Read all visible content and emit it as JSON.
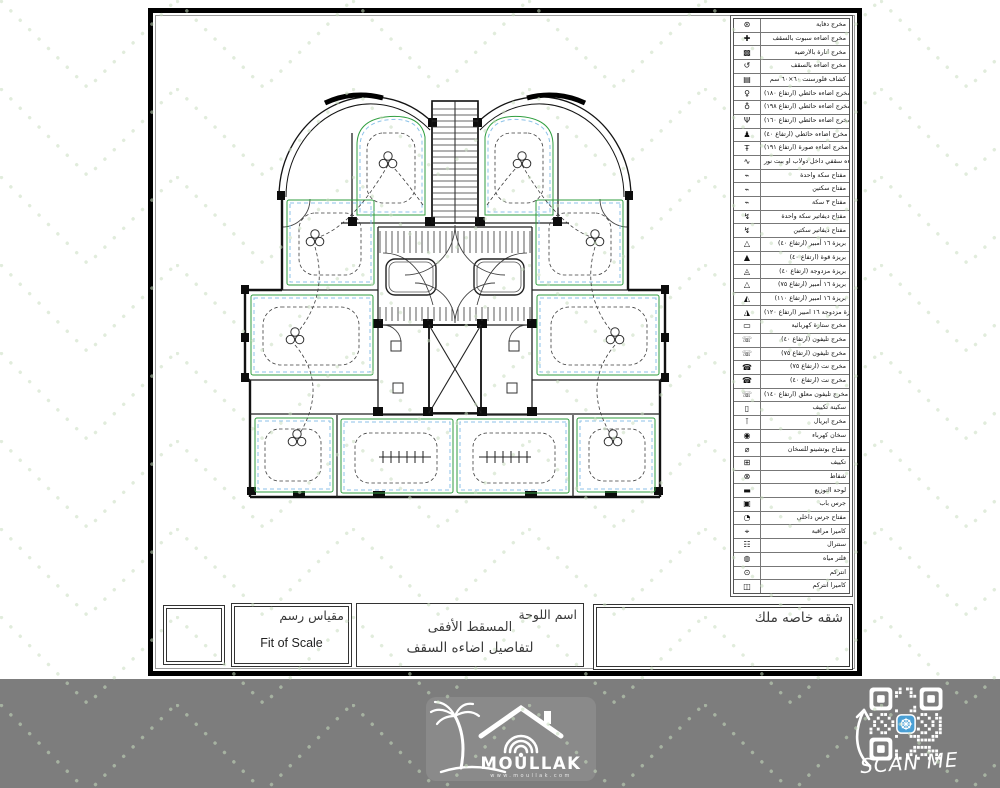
{
  "colors": {
    "pattern_dots": "#c9dec0",
    "bottom_strip": "#7d7d7d",
    "plan_green": "#2f9e3f",
    "plan_blue": "#8cc2e8",
    "qr_accent": "#4a9fd4"
  },
  "legend": {
    "rows": [
      {
        "name": "heater-outlet",
        "glyph": "⊛",
        "label": "مخرج دفاية"
      },
      {
        "name": "ceiling-spot-outlet",
        "glyph": "✚",
        "label": "مخرج اضاءه سبوت بالسقف"
      },
      {
        "name": "floor-light-outlet",
        "glyph": "▩",
        "label": "مخرج انارة بالارضية"
      },
      {
        "name": "ceiling-light-outlet",
        "glyph": "↺",
        "label": "مخرج اضاءه بالسقف"
      },
      {
        "name": "fluorescent-60x60",
        "glyph": "▤",
        "label": "كشاف فلورسنت ٦٠×٦٠ سم"
      },
      {
        "name": "wall-light-180",
        "glyph": "♀",
        "label": "مخرج اضاءه حائطي (ارتفاع ١٨٠)"
      },
      {
        "name": "wall-light-198",
        "glyph": "♁",
        "label": "مخرج اضاءه حائطي (ارتفاع ١٩٨)"
      },
      {
        "name": "wall-light-160",
        "glyph": "Ψ",
        "label": "مخرج اضاءه حائطي (ارتفاع ١٦٠)"
      },
      {
        "name": "wall-light-40",
        "glyph": "♟",
        "label": "مخرج اضاءه حائطي (ارتفاع ٤٠)"
      },
      {
        "name": "picture-light-191",
        "glyph": "Ŧ",
        "label": "مخرج اضاءه صورة (ارتفاع ١٩١)"
      },
      {
        "name": "closet-light-outlet",
        "glyph": "∿",
        "label": "مخرج اضاءه سقفي داخل دولاب او بيت نور"
      },
      {
        "name": "one-gang-switch",
        "glyph": "⌁",
        "label": "مفتاح سكة واحدة"
      },
      {
        "name": "two-gang-switch",
        "glyph": "⌁",
        "label": "مفتاح سكتين"
      },
      {
        "name": "three-gang-switch",
        "glyph": "⌁",
        "label": "مفتاح ٣ سكة"
      },
      {
        "name": "diverter-switch-one",
        "glyph": "↯",
        "label": "مفتاح ديفاتير سكة واحدة"
      },
      {
        "name": "diverter-switch-two",
        "glyph": "↯",
        "label": "مفتاح ديفاتير سكتين"
      },
      {
        "name": "socket-16a-40",
        "glyph": "△",
        "label": "بريزة ١٦ أمبير (ارتفاع ٤٠)"
      },
      {
        "name": "power-socket-40",
        "glyph": "▲",
        "label": "بريزة قوة (ارتفاع ٤٠)"
      },
      {
        "name": "double-socket-40",
        "glyph": "◬",
        "label": "بريزة مزدوجة (ارتفاع ٤٠)"
      },
      {
        "name": "socket-16a-75",
        "glyph": "△",
        "label": "بريزة ١٦ أمبير (ارتفاع ٧٥)"
      },
      {
        "name": "socket-16a-110",
        "glyph": "◭",
        "label": "بريزة ١٦ امبير (ارتفاع ١١٠)"
      },
      {
        "name": "double-socket-16a-120",
        "glyph": "◮",
        "label": "بريزة مزدوجة ١٦ امبير (ارتفاع ١٢٠)"
      },
      {
        "name": "electric-curtain-outlet",
        "glyph": "▭",
        "label": "مخرج ستارة كهربائية"
      },
      {
        "name": "phone-outlet-40",
        "glyph": "☏",
        "label": "مخرج تليفون (ارتفاع ٤٠)"
      },
      {
        "name": "phone-outlet-75",
        "glyph": "☏",
        "label": "مخرج تليفون (ارتفاع ٧٥)"
      },
      {
        "name": "net-outlet-75",
        "glyph": "☎",
        "label": "مخرج نت (ارتفاع ٧٥)"
      },
      {
        "name": "net-outlet-40",
        "glyph": "☎",
        "label": "مخرج نت (ارتفاع ٤٠)"
      },
      {
        "name": "wall-phone-outlet-140",
        "glyph": "☏",
        "label": "مخرج تليفون معلق (ارتفاع ١٤٠)"
      },
      {
        "name": "ac-isolator",
        "glyph": "▯",
        "label": "سكينة تكييف"
      },
      {
        "name": "aerial-outlet",
        "glyph": "⊺",
        "label": "مخرج ايريال"
      },
      {
        "name": "electric-heater",
        "glyph": "◉",
        "label": "سخان كهرباء"
      },
      {
        "name": "heater-switch",
        "glyph": "⌀",
        "label": "مفتاح بوتشينو للسخان"
      },
      {
        "name": "air-conditioner",
        "glyph": "⊞",
        "label": "تكييف"
      },
      {
        "name": "exhaust-fan",
        "glyph": "⊗",
        "label": "شفاط"
      },
      {
        "name": "distribution-board",
        "glyph": "▬",
        "label": "لوحة التوزيع"
      },
      {
        "name": "door-bell",
        "glyph": "▣",
        "label": "جرس باب"
      },
      {
        "name": "indoor-bell-switch",
        "glyph": "◔",
        "label": "مفتاح جرس داخلي"
      },
      {
        "name": "cctv-camera",
        "glyph": "⌖",
        "label": "كاميرا مراقبة"
      },
      {
        "name": "central-unit",
        "glyph": "☷",
        "label": "سنترال"
      },
      {
        "name": "water-filter",
        "glyph": "◍",
        "label": "فلتر مياه"
      },
      {
        "name": "intercom",
        "glyph": "⊙",
        "label": "انتركم"
      },
      {
        "name": "intercom-camera",
        "glyph": "◫",
        "label": "كاميرا انتركم"
      }
    ]
  },
  "title_block": {
    "sheet_name_label": "اسم اللوحة",
    "sheet_name": "المسقط الأفقى",
    "sheet_desc": "لتفاصيل اضاءه السقف",
    "scale_label_ar": "مقياس رسم",
    "scale_value": "Fit of Scale",
    "owner": "شقه خاصه ملك"
  },
  "branding": {
    "name": "MOULLAK",
    "url": "www.moullak.com"
  },
  "qr": {
    "caption": "SCAN ME"
  }
}
